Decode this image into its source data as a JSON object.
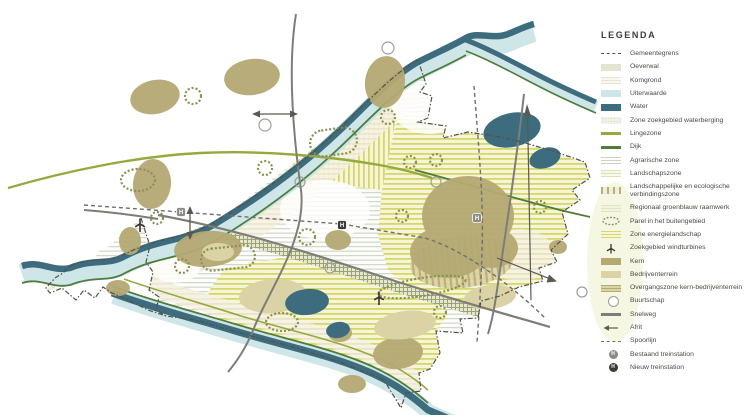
{
  "legend": {
    "title": "LEGENDA",
    "items": [
      {
        "name": "gemeentegrens",
        "label": "Gemeentegrens",
        "type": "dashdot",
        "color": "#52524a"
      },
      {
        "name": "oeverwal",
        "label": "Oeverwal",
        "type": "solid",
        "color": "#e3e4d4"
      },
      {
        "name": "komgrond",
        "label": "Komgrond",
        "type": "stripes",
        "color": "#faf7ec",
        "color2": "#e9e3d0"
      },
      {
        "name": "uiterwaarde",
        "label": "Uiterwaarde",
        "type": "solid",
        "color": "#cee6e8"
      },
      {
        "name": "water",
        "label": "Water",
        "type": "solid",
        "color": "#3d6c7e"
      },
      {
        "name": "zone-zoekgebied-waterberging",
        "label": "Zone zoekgebied waterberging",
        "type": "dots",
        "color": "#f2f1e6",
        "color2": "#d8d6c0"
      },
      {
        "name": "lingezone",
        "label": "Lingezone",
        "type": "line",
        "color": "#97a93e"
      },
      {
        "name": "dijk",
        "label": "Dijk",
        "type": "line",
        "color": "#4e7c3a"
      },
      {
        "name": "agrarische-zone",
        "label": "Agrarische zone",
        "type": "stripes",
        "color": "#fdfdfa",
        "color2": "#ccd3c6"
      },
      {
        "name": "landschapszone",
        "label": "Landschapszone",
        "type": "stripes",
        "color": "#f7f8ea",
        "color2": "#dce3b0"
      },
      {
        "name": "verbindingszone",
        "label": "Landschappelijke en ecologische verbindingszone",
        "type": "bars",
        "color": "#f1efdc",
        "color2": "#b5b07c"
      },
      {
        "name": "regionaal-groenblauw-raamwerk",
        "label": "Regionaal groenblauw raamwerk",
        "type": "stripes",
        "color": "#f2f4e0",
        "color2": "#dfe5c0"
      },
      {
        "name": "parel-buitengebied",
        "label": "Parel in het buitengebied",
        "type": "parel",
        "color": "#8a9153"
      },
      {
        "name": "zone-energielandschap",
        "label": "Zone energielandschap",
        "type": "stripes",
        "color": "#f6f5d8",
        "color2": "#d5d76d"
      },
      {
        "name": "zoekgebied-windturbines",
        "label": "Zoekgebied windturbines",
        "type": "turbine",
        "color": "#35352f"
      },
      {
        "name": "kern",
        "label": "Kern",
        "type": "solid",
        "color": "#b5a973"
      },
      {
        "name": "bedrijventerrein",
        "label": "Bedrijventerrein",
        "type": "solid",
        "color": "#dbd3a6"
      },
      {
        "name": "overgangszone-kern-bedrijventerrein",
        "label": "Overgangszone kern-bedrijventerrein",
        "type": "stripes",
        "color": "#dbd3a6",
        "color2": "#b5a973"
      },
      {
        "name": "buurtschap",
        "label": "Buurtschap",
        "type": "circle",
        "color": "#9aa098"
      },
      {
        "name": "snelweg",
        "label": "Snelweg",
        "type": "line",
        "color": "#7e7d77"
      },
      {
        "name": "afrit",
        "label": "Afrit",
        "type": "afrit",
        "color": "#5a5a52"
      },
      {
        "name": "spoorlijn",
        "label": "Spoorlijn",
        "type": "dashline",
        "color": "#70706a"
      },
      {
        "name": "bestaand-treinstation",
        "label": "Bestaand treinstation",
        "type": "station",
        "color": "#8b8b85"
      },
      {
        "name": "nieuw-treinstation",
        "label": "Nieuw treinstation",
        "type": "station",
        "color": "#3b3b36"
      }
    ]
  },
  "colors": {
    "boundary": "#52524a",
    "water": "#3d6c7e",
    "uiterwaarde": "#cee6e8",
    "dijk": "#4e7c3a",
    "lingezone": "#97a93e",
    "kern": "#b5a973",
    "bedrijventerrein": "#dbd3a6",
    "snelweg": "#7e7d77",
    "spoor": "#70706a",
    "parel": "#8a9153",
    "buurtschap": "#9aa098",
    "station_bestaand": "#8b8b85",
    "station_nieuw": "#3b3b36",
    "turbine": "#35352f",
    "arrow": "#5a5a52"
  },
  "map": {
    "station_glyph": "H",
    "stations": [
      {
        "x": 181,
        "y": 212,
        "kind": "bestaand"
      },
      {
        "x": 342,
        "y": 225,
        "kind": "nieuw"
      },
      {
        "x": 477,
        "y": 218,
        "kind": "bestaand"
      }
    ],
    "turbines": [
      {
        "x": 140,
        "y": 224
      },
      {
        "x": 379,
        "y": 297
      }
    ]
  }
}
